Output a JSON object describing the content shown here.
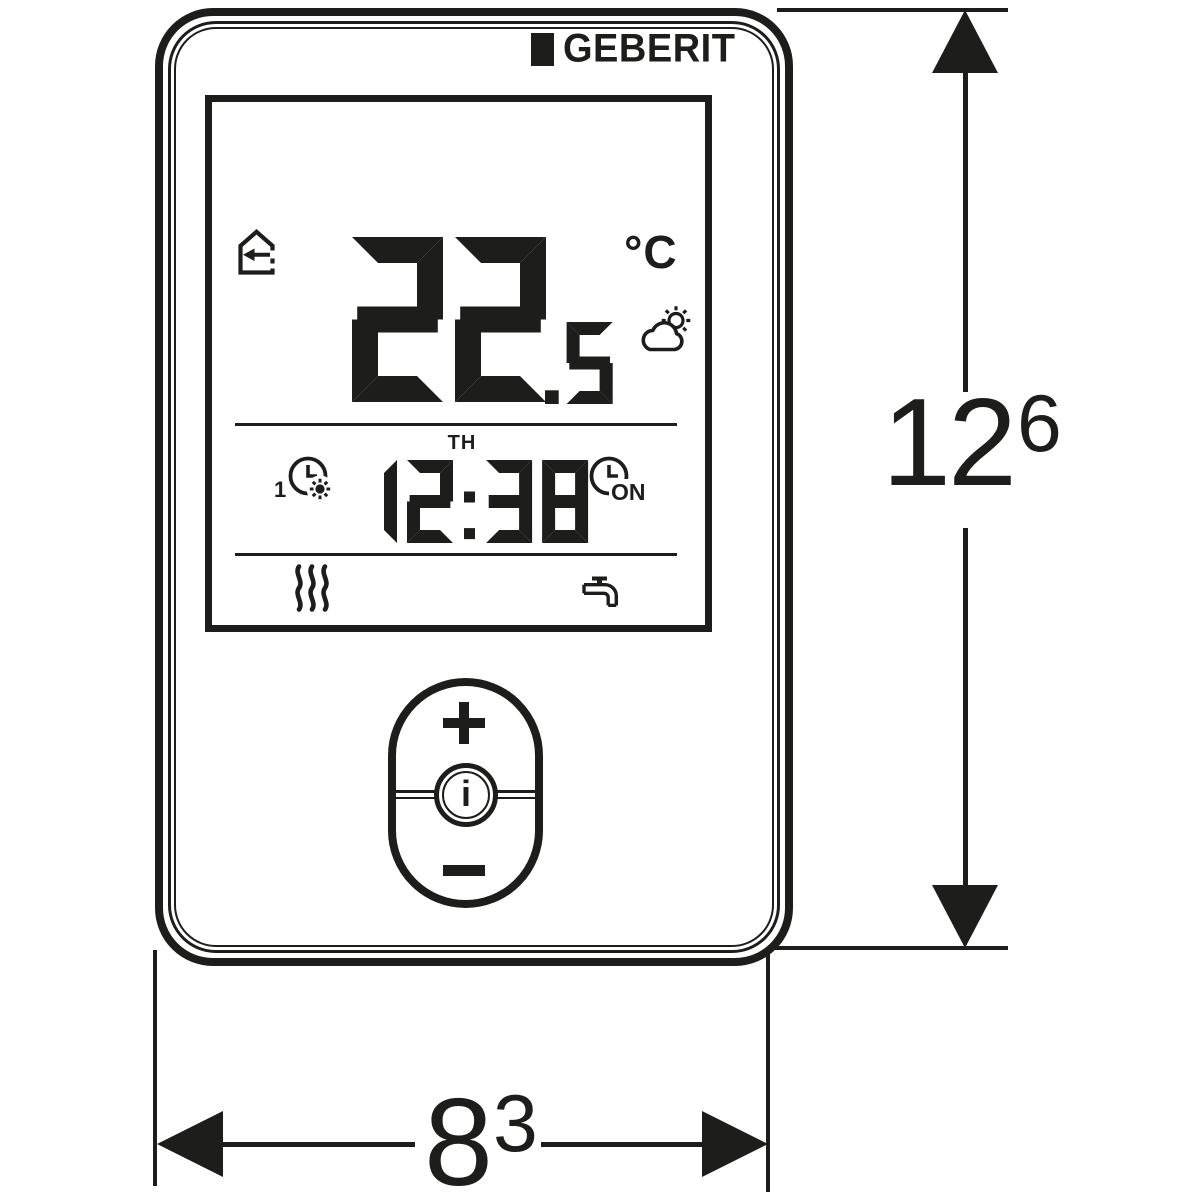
{
  "brand": {
    "logo_text": "GEBERIT",
    "logo_mark": "black-square"
  },
  "display": {
    "mode_icon": "home-presence-arrow",
    "temperature": {
      "integer": "22",
      "decimal": ".5",
      "unit": "°C"
    },
    "weather_icon": "sun-behind-cloud",
    "day": "TH",
    "time": "12:38",
    "program_comfort": {
      "index": "1",
      "icon": "clock-sun"
    },
    "program_on": {
      "index": "1",
      "label": "ON",
      "icon": "clock-on"
    },
    "status_icons": [
      "heating-waves",
      "water-tap"
    ]
  },
  "controls": {
    "plus": "+",
    "minus": "−",
    "info": "i"
  },
  "dimensions": {
    "height": {
      "value": "12",
      "superscript": "6"
    },
    "width": {
      "value": "8",
      "superscript": "3"
    }
  },
  "colors": {
    "ink": "#1d1d1b",
    "background": "#ffffff"
  }
}
